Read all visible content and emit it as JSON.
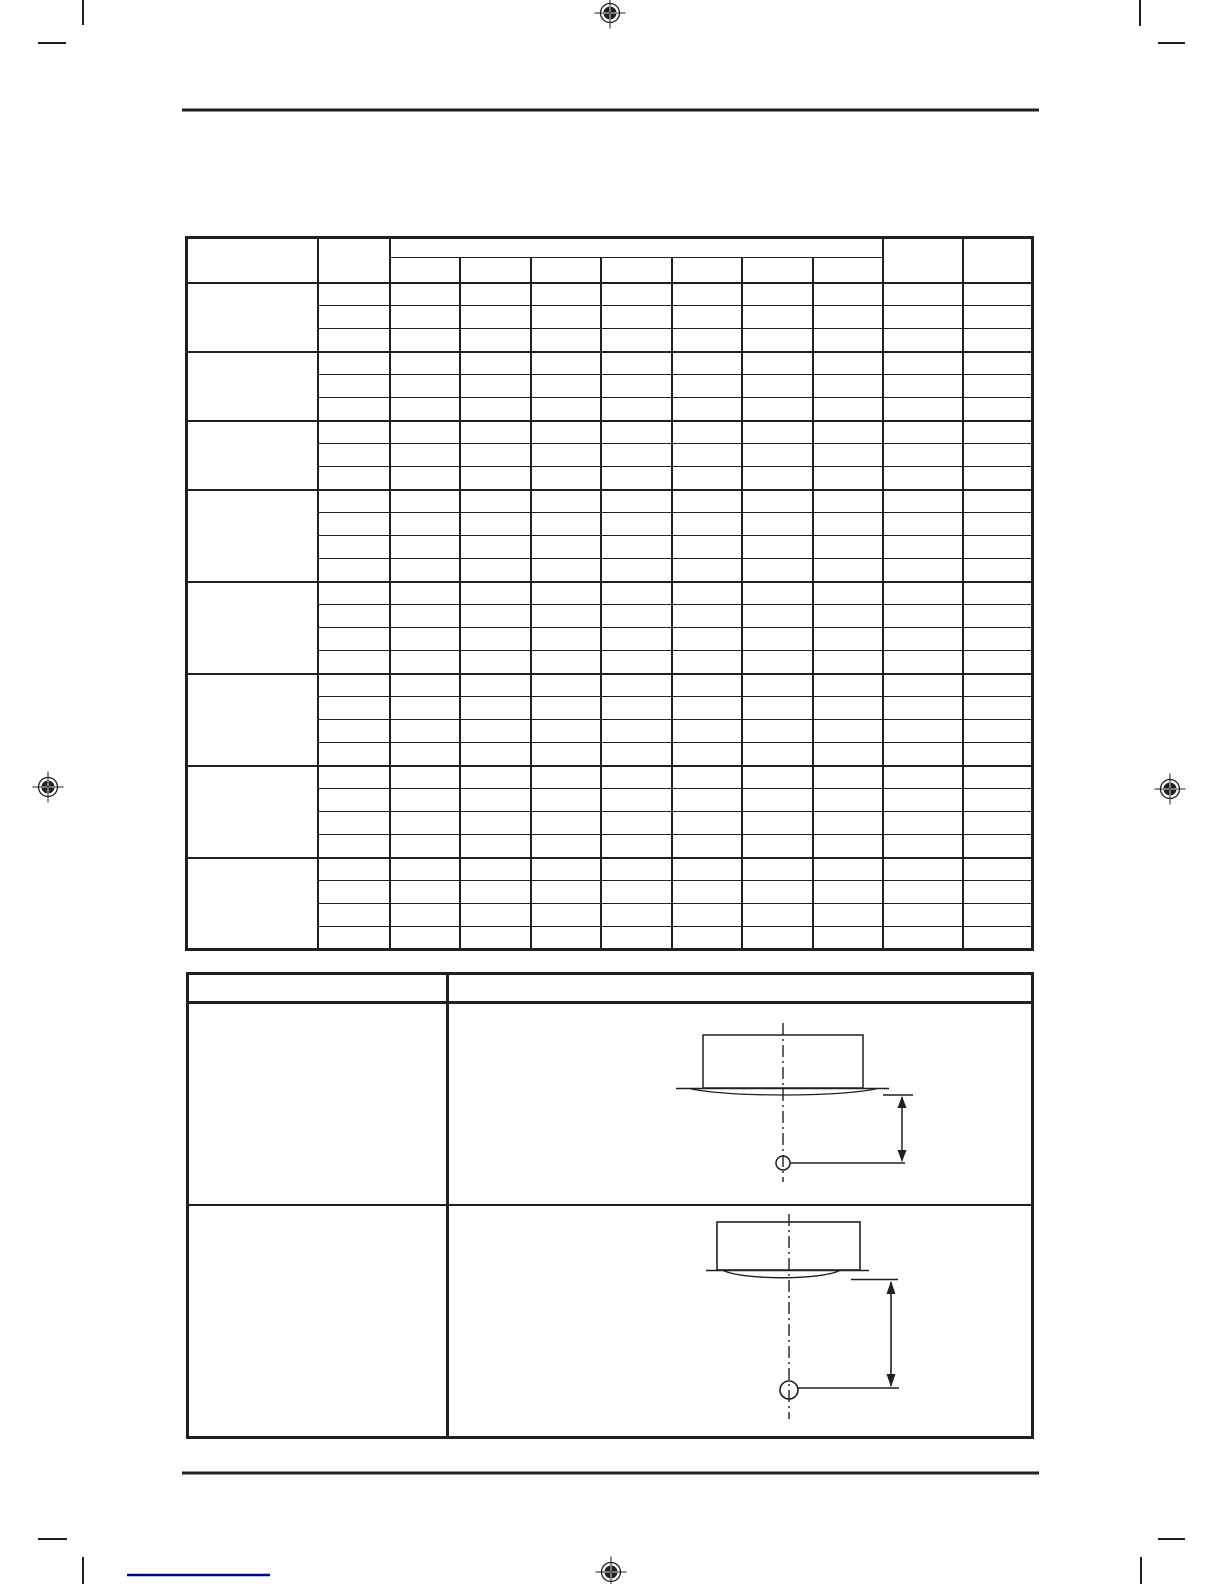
{
  "page": {
    "kind": "printed-manual-page-blank-template",
    "width_px": 1224,
    "height_px": 1584
  },
  "colors": {
    "paper": "#ffffff",
    "ink": "#221f20",
    "footer_line": "#00008b"
  },
  "print_marks": {
    "registration": [
      {
        "x": 610,
        "y": 13
      },
      {
        "x": 48,
        "y": 787
      },
      {
        "x": 1170,
        "y": 789
      },
      {
        "x": 611,
        "y": 1572
      }
    ],
    "trim_lines": [
      {
        "x1": 83,
        "y1": 0,
        "x2": 83,
        "y2": 25
      },
      {
        "x1": 38,
        "y1": 43,
        "x2": 66,
        "y2": 43
      },
      {
        "x1": 1140,
        "y1": 0,
        "x2": 1140,
        "y2": 26
      },
      {
        "x1": 1158,
        "y1": 43,
        "x2": 1185,
        "y2": 43
      },
      {
        "x1": 38,
        "y1": 1539,
        "x2": 67,
        "y2": 1539
      },
      {
        "x1": 83,
        "y1": 1557,
        "x2": 83,
        "y2": 1584
      },
      {
        "x1": 1158,
        "y1": 1539,
        "x2": 1185,
        "y2": 1539
      },
      {
        "x1": 1141,
        "y1": 1557,
        "x2": 1141,
        "y2": 1584
      }
    ]
  },
  "rules": {
    "top": {
      "x1": 182,
      "x2": 1039,
      "y": 110,
      "thickness": 3
    },
    "bottom": {
      "x1": 182,
      "x2": 1039,
      "y": 1473,
      "thickness": 3
    },
    "footer_segment": {
      "x1": 127,
      "x2": 270,
      "y": 1575,
      "thickness": 2.5
    }
  },
  "table1": {
    "description": "empty specification grid, no visible text",
    "column_count": 11,
    "column_widths": [
      131,
      72,
      70,
      71,
      70,
      71,
      70,
      71,
      70,
      80,
      70
    ],
    "header": {
      "rows": 2,
      "merged_span_start_col": 3,
      "merged_span_columns": 7
    },
    "row_groups": [
      3,
      3,
      3,
      4,
      4,
      4,
      4,
      4
    ]
  },
  "table2": {
    "description": "empty two-column table, header row plus two rows with installation diagrams",
    "column_widths": [
      260,
      585
    ],
    "row_heights": [
      29,
      202,
      233
    ]
  },
  "diagrams": [
    {
      "id": "diagram-1",
      "name": "ceiling-unit-side-view-small",
      "parts": [
        "unit-box",
        "ceiling-line",
        "panel-curve",
        "center-dash-dot-line",
        "reference-circle",
        "reference-leader-line",
        "dimension-reference-tick",
        "dimension-arrow"
      ]
    },
    {
      "id": "diagram-2",
      "name": "ceiling-unit-side-view-large",
      "parts": [
        "unit-box",
        "ceiling-line",
        "panel-curve",
        "center-dash-dot-line",
        "reference-circle",
        "reference-leader-line",
        "dimension-reference-line",
        "dimension-arrow"
      ]
    }
  ]
}
